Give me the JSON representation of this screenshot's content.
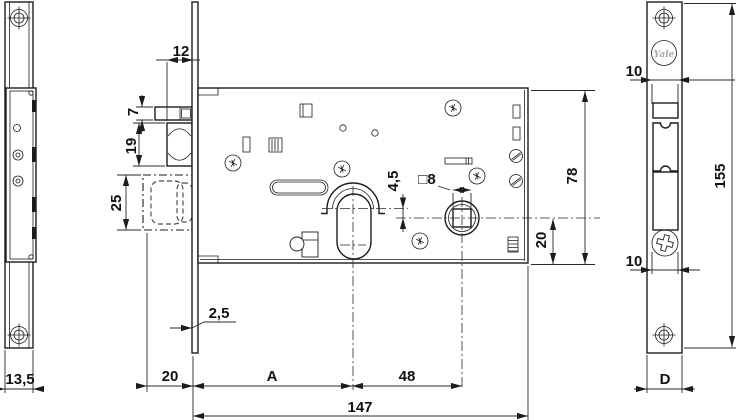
{
  "colors": {
    "background": "#ffffff",
    "line": "#1c1c1c",
    "logo_gray": "#a8a8a8"
  },
  "side_view": {
    "width": "13,5"
  },
  "front_view": {
    "latch_projection": "12",
    "aux_latch_height": "7",
    "latch_height": "19",
    "deadbolt_height": "25",
    "faceplate_thickness": "2,5",
    "deadbolt_throw": "20",
    "backset": "A",
    "axis_distance": "48",
    "case_length": "147",
    "axis_offset": "4,5",
    "spindle_square": "□8",
    "case_height": "78",
    "axis_to_bottom": "20"
  },
  "faceplate_view": {
    "brand": "Yale",
    "slot_width_top": "10",
    "slot_width_bottom": "10",
    "height": "155",
    "width": "D"
  }
}
